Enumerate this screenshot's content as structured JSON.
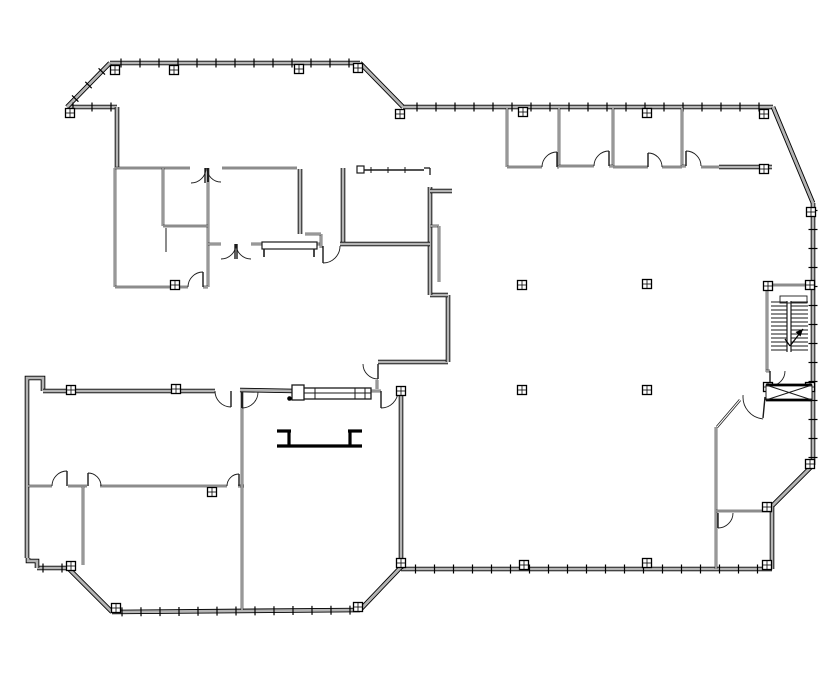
{
  "drawing": {
    "kind": "architectural-floor-plan",
    "canvas": {
      "width": 835,
      "height": 678,
      "background": "#ffffff",
      "line_color": "#1a1a1a",
      "wall_core_color": "#b4b4b4"
    },
    "exterior_walls": [
      {
        "p": [
          [
            110,
            63
          ],
          [
            360,
            63
          ]
        ],
        "ticks": true
      },
      {
        "p": [
          [
            360,
            63
          ],
          [
            403,
            107
          ]
        ],
        "ticks": false
      },
      {
        "p": [
          [
            403,
            107
          ],
          [
            773,
            107
          ]
        ],
        "ticks": true
      },
      {
        "p": [
          [
            773,
            107
          ],
          [
            813,
            203
          ]
        ],
        "ticks": false
      },
      {
        "p": [
          [
            813,
            203
          ],
          [
            813,
            465
          ]
        ],
        "ticks": true
      },
      {
        "p": [
          [
            813,
            465
          ],
          [
            772,
            506
          ]
        ],
        "ticks": false
      },
      {
        "p": [
          [
            772,
            506
          ],
          [
            772,
            569
          ]
        ],
        "ticks": false
      },
      {
        "p": [
          [
            401,
            569
          ],
          [
            772,
            569
          ]
        ],
        "ticks": true
      },
      {
        "p": [
          [
            401,
            391
          ],
          [
            401,
            569
          ]
        ],
        "ticks": false
      },
      {
        "p": [
          [
            401,
            567
          ],
          [
            360,
            610
          ]
        ],
        "ticks": false
      },
      {
        "p": [
          [
            112,
            612
          ],
          [
            360,
            610
          ]
        ],
        "ticks": true
      },
      {
        "p": [
          [
            68,
            568
          ],
          [
            112,
            612
          ]
        ],
        "ticks": false
      },
      {
        "p": [
          [
            37,
            568
          ],
          [
            68,
            568
          ]
        ],
        "ticks": true
      },
      {
        "p": [
          [
            28,
            558
          ],
          [
            28,
            561
          ],
          [
            37,
            561
          ],
          [
            37,
            568
          ]
        ],
        "ticks": false
      },
      {
        "p": [
          [
            27,
            558
          ],
          [
            27,
            381
          ]
        ],
        "ticks": false
      },
      {
        "p": [
          [
            27,
            381
          ],
          [
            27,
            378
          ],
          [
            43,
            378
          ],
          [
            43,
            391
          ]
        ],
        "ticks": false
      },
      {
        "p": [
          [
            43,
            391
          ],
          [
            215,
            391
          ]
        ],
        "ticks": false
      },
      {
        "p": [
          [
            240,
            390
          ],
          [
            295,
            391
          ]
        ],
        "ticks": false
      },
      {
        "p": [
          [
            378,
            362
          ],
          [
            448,
            362
          ]
        ],
        "ticks": false
      },
      {
        "p": [
          [
            448,
            295
          ],
          [
            448,
            362
          ]
        ],
        "ticks": false
      },
      {
        "p": [
          [
            430,
            295
          ],
          [
            448,
            295
          ]
        ],
        "ticks": false
      },
      {
        "p": [
          [
            430,
            187
          ],
          [
            430,
            295
          ]
        ],
        "ticks": false
      },
      {
        "p": [
          [
            430,
            191
          ],
          [
            452,
            191
          ]
        ],
        "ticks": false
      },
      {
        "p": [
          [
            67,
            107
          ],
          [
            117,
            107
          ]
        ],
        "ticks": true
      },
      {
        "p": [
          [
            67,
            107
          ],
          [
            110,
            63
          ]
        ],
        "ticks": true
      },
      {
        "p": [
          [
            117,
            107
          ],
          [
            117,
            168
          ]
        ],
        "ticks": false
      },
      {
        "p": [
          [
            343,
            168
          ],
          [
            343,
            244
          ]
        ],
        "ticks": false
      },
      {
        "p": [
          [
            340,
            244
          ],
          [
            430,
            244
          ]
        ],
        "ticks": false
      },
      {
        "p": [
          [
            300,
            169
          ],
          [
            300,
            234
          ]
        ],
        "ticks": false
      },
      {
        "p": [
          [
            719,
            167
          ],
          [
            772,
            167
          ]
        ],
        "ticks": false
      }
    ],
    "interior_walls": [
      [
        115,
        168,
        115,
        287
      ],
      [
        115,
        168,
        190,
        168
      ],
      [
        222,
        168,
        297,
        168
      ],
      [
        208,
        168,
        208,
        287
      ],
      [
        163,
        168,
        163,
        226
      ],
      [
        163,
        226,
        208,
        226
      ],
      [
        115,
        287,
        188,
        287
      ],
      [
        203,
        287,
        208,
        287
      ],
      [
        208,
        244,
        221,
        244
      ],
      [
        251,
        244,
        262,
        244
      ],
      [
        317,
        244,
        321,
        244
      ],
      [
        321,
        234,
        321,
        248
      ],
      [
        305,
        234,
        321,
        234
      ],
      [
        507,
        108,
        507,
        167
      ],
      [
        559,
        108,
        559,
        167
      ],
      [
        613,
        108,
        613,
        167
      ],
      [
        682,
        108,
        682,
        167
      ],
      [
        507,
        167,
        542,
        167
      ],
      [
        557,
        167,
        559,
        167
      ],
      [
        559,
        166,
        594,
        166
      ],
      [
        609,
        166,
        613,
        166
      ],
      [
        613,
        167,
        648,
        167
      ],
      [
        662,
        167,
        682,
        167
      ],
      [
        682,
        166,
        686,
        166
      ],
      [
        701,
        167,
        719,
        167
      ],
      [
        765,
        285,
        813,
        285
      ],
      [
        767,
        285,
        767,
        372
      ],
      [
        766,
        371,
        770,
        371
      ],
      [
        740,
        400,
        717,
        427
      ],
      [
        716,
        427,
        716,
        569
      ],
      [
        716,
        511,
        772,
        511
      ],
      [
        28,
        486,
        52,
        486
      ],
      [
        68,
        486,
        87,
        486
      ],
      [
        100,
        486,
        227,
        486
      ],
      [
        238,
        486,
        244,
        486
      ],
      [
        83,
        487,
        83,
        565
      ],
      [
        242,
        392,
        242,
        610
      ],
      [
        430,
        226,
        439,
        226
      ],
      [
        439,
        226,
        439,
        282
      ],
      [
        371,
        391,
        381,
        391
      ],
      [
        377,
        380,
        377,
        389
      ]
    ],
    "thin_lines": [
      [
        166,
        228,
        166,
        252
      ]
    ],
    "doors": [
      {
        "c": [
          191,
          168
        ],
        "r": 15,
        "a1": 0,
        "a2": 90,
        "leaf": [
          205,
          168,
          205,
          183
        ]
      },
      {
        "c": [
          221,
          168
        ],
        "r": 14,
        "a1": 90,
        "a2": 180,
        "leaf": [
          208,
          168,
          208,
          182
        ]
      },
      {
        "c": [
          203,
          287
        ],
        "r": 15,
        "a1": 180,
        "a2": 270,
        "leaf": [
          203,
          287,
          203,
          272
        ]
      },
      {
        "c": [
          221,
          244
        ],
        "r": 15,
        "a1": 0,
        "a2": 90,
        "leaf": [
          235,
          244,
          235,
          259
        ]
      },
      {
        "c": [
          251,
          244
        ],
        "r": 15,
        "a1": 90,
        "a2": 180,
        "leaf": [
          237,
          244,
          237,
          259
        ]
      },
      {
        "c": [
          323,
          246
        ],
        "r": 17,
        "a1": 0,
        "a2": 90,
        "leaf": [
          323,
          246,
          323,
          263
        ]
      },
      {
        "c": [
          231,
          391
        ],
        "r": 16,
        "a1": 90,
        "a2": 180,
        "leaf": [
          231,
          391,
          231,
          407
        ]
      },
      {
        "c": [
          242,
          392
        ],
        "r": 16,
        "a1": 0,
        "a2": 90,
        "leaf": [
          242,
          392,
          242,
          408
        ]
      },
      {
        "c": [
          378,
          364
        ],
        "r": 15,
        "a1": 90,
        "a2": 180,
        "leaf": [
          378,
          364,
          378,
          379
        ]
      },
      {
        "c": [
          381,
          391
        ],
        "r": 17,
        "a1": 0,
        "a2": 90,
        "leaf": [
          381,
          391,
          381,
          408
        ]
      },
      {
        "c": [
          67,
          486
        ],
        "r": 15,
        "a1": 180,
        "a2": 270,
        "leaf": [
          67,
          486,
          67,
          471
        ]
      },
      {
        "c": [
          88,
          486
        ],
        "r": 13,
        "a1": 270,
        "a2": 360,
        "leaf": [
          88,
          486,
          88,
          473
        ]
      },
      {
        "c": [
          239,
          486
        ],
        "r": 12,
        "a1": 180,
        "a2": 270,
        "leaf": [
          239,
          486,
          239,
          474
        ]
      },
      {
        "c": [
          557,
          167
        ],
        "r": 15,
        "a1": 180,
        "a2": 270,
        "leaf": [
          557,
          167,
          557,
          152
        ]
      },
      {
        "c": [
          609,
          166
        ],
        "r": 15,
        "a1": 180,
        "a2": 270,
        "leaf": [
          609,
          166,
          609,
          151
        ]
      },
      {
        "c": [
          648,
          167
        ],
        "r": 14,
        "a1": 270,
        "a2": 360,
        "leaf": [
          648,
          167,
          648,
          153
        ]
      },
      {
        "c": [
          686,
          166
        ],
        "r": 15,
        "a1": 270,
        "a2": 360,
        "leaf": [
          686,
          166,
          686,
          151
        ]
      },
      {
        "c": [
          770,
          371
        ],
        "r": 15,
        "a1": 0,
        "a2": 90,
        "leaf": [
          770,
          371,
          770,
          386
        ]
      },
      {
        "c": [
          765,
          397
        ],
        "r": 22,
        "a1": 95,
        "a2": 185,
        "leaf": [
          765,
          397,
          763,
          418
        ]
      },
      {
        "c": [
          718,
          513
        ],
        "r": 15,
        "a1": 0,
        "a2": 90,
        "leaf": [
          718,
          513,
          718,
          528
        ]
      }
    ],
    "columns": [
      [
        115,
        70
      ],
      [
        174,
        70
      ],
      [
        70,
        113
      ],
      [
        299,
        69
      ],
      [
        358,
        68
      ],
      [
        400,
        114
      ],
      [
        523,
        112
      ],
      [
        647,
        113
      ],
      [
        764,
        114
      ],
      [
        811,
        212
      ],
      [
        764,
        169
      ],
      [
        522,
        285
      ],
      [
        647,
        284
      ],
      [
        522,
        390
      ],
      [
        647,
        390
      ],
      [
        768,
        286
      ],
      [
        810,
        285
      ],
      [
        768,
        387
      ],
      [
        810,
        387
      ],
      [
        810,
        464
      ],
      [
        767,
        507
      ],
      [
        767,
        565
      ],
      [
        647,
        563
      ],
      [
        524,
        565
      ],
      [
        401,
        391
      ],
      [
        401,
        563
      ],
      [
        358,
        607
      ],
      [
        116,
        608
      ],
      [
        71,
        566
      ],
      [
        71,
        390
      ],
      [
        176,
        389
      ],
      [
        212,
        492
      ],
      [
        175,
        285
      ]
    ],
    "glazing": {
      "line": [
        362,
        170,
        424,
        170
      ],
      "tick_step": 17,
      "end_box": [
        357,
        166,
        7,
        7
      ],
      "bracket": [
        [
          424,
          168,
          430,
          168
        ],
        [
          430,
          168,
          430,
          175
        ]
      ]
    },
    "sill_band": {
      "rect": [
        295,
        388,
        76,
        11
      ],
      "inner_y": 393,
      "dividers": [
        315,
        355,
        365
      ],
      "end_box": [
        292,
        385,
        12,
        15
      ]
    },
    "counter": {
      "rect": [
        262,
        242,
        55,
        7
      ],
      "legs": [
        [
          264,
          249,
          264,
          257
        ],
        [
          314,
          249,
          314,
          257
        ]
      ]
    },
    "desk": [
      [
        277,
        431,
        291,
        431
      ],
      [
        289,
        431,
        289,
        447
      ],
      [
        277,
        446,
        362,
        446
      ],
      [
        350,
        431,
        350,
        447
      ],
      [
        348,
        431,
        362,
        431
      ]
    ],
    "dot": [
      289.5,
      398.5
    ],
    "stair": {
      "treads": {
        "x1": 771,
        "x2": 808,
        "y0": 302,
        "step": 4,
        "count": 13
      },
      "stringer": {
        "x1": 787,
        "x2": 791,
        "y1": 301,
        "y2": 352
      },
      "landing": [
        780,
        296,
        27,
        7
      ],
      "arrow": {
        "line": [
          790,
          346,
          803,
          329
        ],
        "tail": [
          790,
          346,
          785,
          339
        ],
        "head": [
          [
            803,
            329
          ],
          [
            800.5,
            336.5
          ],
          [
            795.5,
            332
          ]
        ]
      }
    },
    "elevator": {
      "rect": [
        766,
        385,
        46,
        15
      ]
    }
  }
}
